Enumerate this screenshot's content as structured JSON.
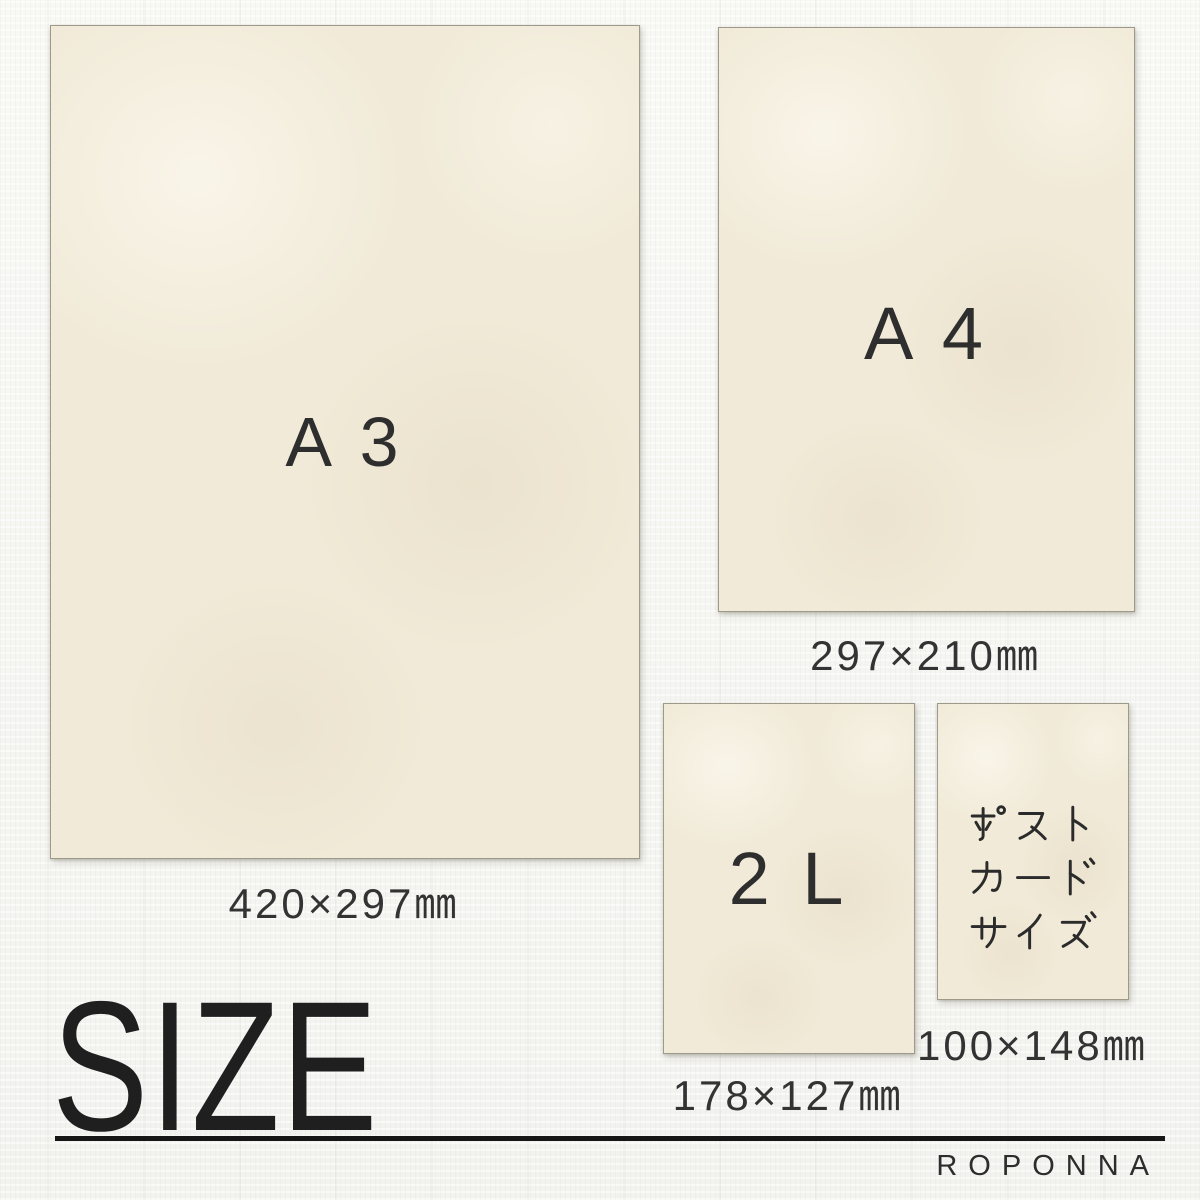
{
  "heading": "SIZE",
  "brand": "ROPONNA",
  "papers": {
    "a3": {
      "label": "A 3",
      "dimensions": "420×297㎜"
    },
    "a4": {
      "label": "A 4",
      "dimensions": "297×210㎜"
    },
    "l2": {
      "label": "2 L",
      "dimensions": "178×127㎜"
    },
    "postcard": {
      "label": "ポストカードサイズ",
      "label_lines": [
        "ポスト",
        "カード",
        "サイズ"
      ],
      "dimensions": "100×148㎜"
    }
  },
  "colors": {
    "paper": "#f1ead8",
    "background": "#f5f5f2",
    "text": "#2e2e2e",
    "divider": "#161616"
  }
}
